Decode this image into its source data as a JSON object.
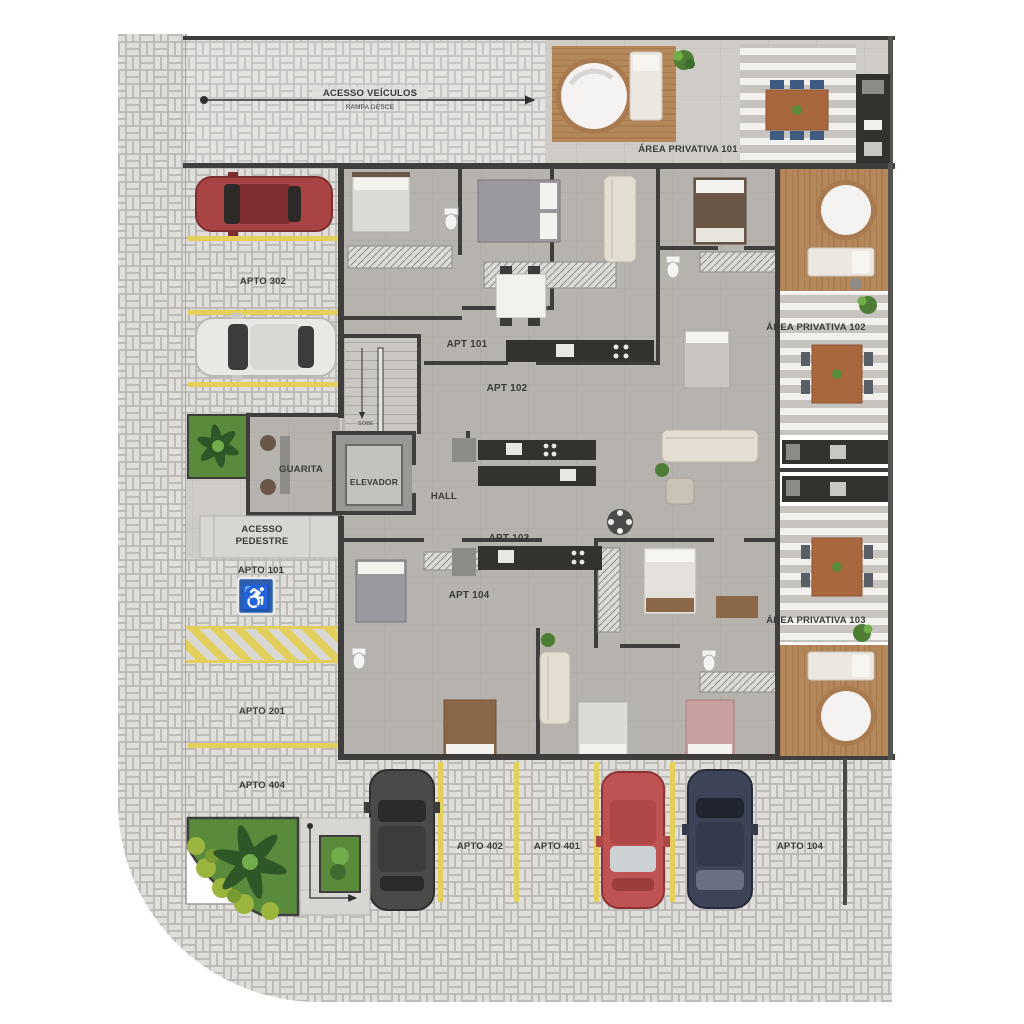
{
  "title": "Floor plan - ground level with parking and private areas",
  "labels": {
    "acesso_veiculos": "ACESSO VEÍCULOS",
    "rampa_desce": "RAMPA DESCE",
    "area_privativa_101": "ÁREA PRIVATIVA 101",
    "area_privativa_102": "ÁREA PRIVATIVA 102",
    "area_privativa_103": "ÁREA PRIVATIVA 103",
    "apt_101": "APT 101",
    "apt_102": "APT 102",
    "apt_103": "APT 103",
    "apt_104": "APT 104",
    "guarita": "GUARITA",
    "elevador": "ELEVADOR",
    "hall": "HALL",
    "sobe": "SOBE",
    "acesso_pedestre_l1": "ACESSO",
    "acesso_pedestre_l2": "PEDESTRE",
    "apto_302": "APTO 302",
    "apto_101": "APTO 101",
    "apto_201": "APTO 201",
    "apto_404": "APTO 404",
    "apto_402": "APTO 402",
    "apto_401": "APTO 401",
    "apto_104": "APTO 104"
  },
  "icons": {
    "handicap": "♿"
  },
  "colors": {
    "wall": "#3f3e3c",
    "paver": "#dfdedb",
    "interior_floor": "#b6b3af",
    "outdoor_floor": "#cfccc7",
    "wood_deck": "#b5885a",
    "parking_line_yellow": "#e3d05c",
    "garden_green": "#5a8a3c",
    "handicap_blue": "#2d5fae",
    "car_red": "#a84444",
    "car_white": "#e9e8e5",
    "car_dark_gray": "#4a4a48",
    "car_bottom_red": "#bf5252",
    "car_navy": "#3e4458"
  }
}
